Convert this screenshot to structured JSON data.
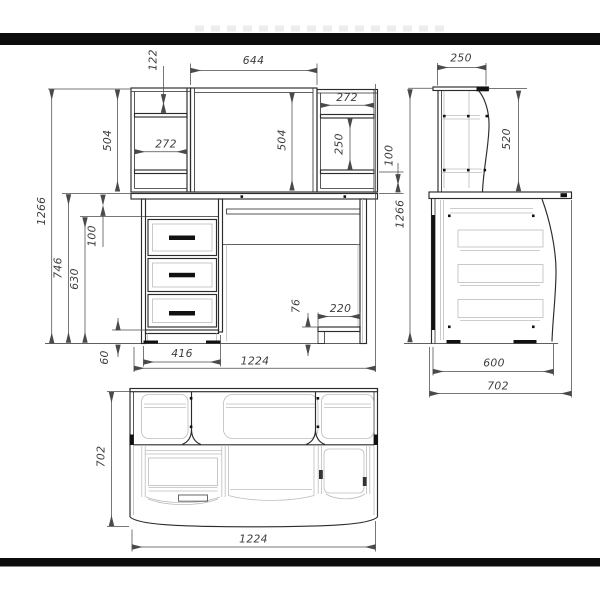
{
  "drawing_title": "furniture-technical-drawing",
  "colors": {
    "line": "#2b2b2b",
    "dim_line": "#4a4a4a",
    "light_line": "#bcbcbc",
    "bar": "#0c0c0c",
    "background": "#ffffff"
  },
  "dims": {
    "front": {
      "top_shelf_gap": "122",
      "mirror_width": "644",
      "right_shelf_width": "272",
      "left_shelf_height": "504",
      "left_shelf_inner_width": "272",
      "mirror_height": "504",
      "right_shelf_inner_height": "250",
      "right_back_gap": "100",
      "total_height": "1266",
      "desk_height": "746",
      "drawer_column_height": "630",
      "drawer_top_offset": "100",
      "plinth_height": "60",
      "drawer_unit_width": "416",
      "desk_width": "1224",
      "footrest_height": "76",
      "footrest_depth": "220"
    },
    "side": {
      "top_depth": "250",
      "top_height": "520",
      "total_height": "1266",
      "body_depth": "600",
      "total_depth": "702"
    },
    "plan": {
      "depth": "702",
      "width": "1224"
    }
  }
}
